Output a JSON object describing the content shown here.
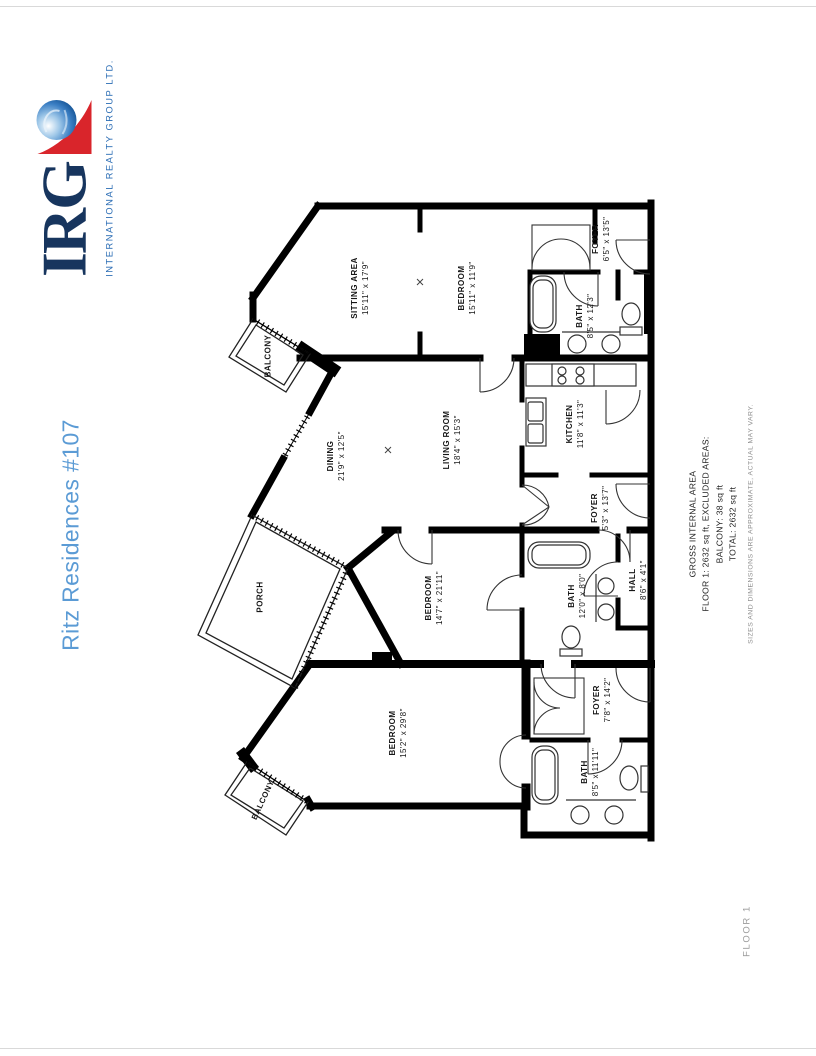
{
  "page": {
    "background": "#ffffff"
  },
  "logo": {
    "name": "IRG",
    "tagline": "INTERNATIONAL REALTY GROUP LTD.",
    "colors": {
      "navy": "#17355E",
      "red": "#D9252B",
      "tagline_blue": "#2A6CB4"
    }
  },
  "title": {
    "text": "Ritz Residences #107",
    "color": "#5B9BD5"
  },
  "plan": {
    "rooms": [
      {
        "name": "SITTING AREA",
        "dims": "15'11\" x 17'9\""
      },
      {
        "name": "BEDROOM",
        "dims": "15'11\" x 11'9\""
      },
      {
        "name": "FOYER",
        "dims": "6'5\" x 13'5\""
      },
      {
        "name": "BATH",
        "dims": "8'5\" x 12'3\""
      },
      {
        "name": "BALCONY",
        "dims": ""
      },
      {
        "name": "DINING",
        "dims": "21'9\" x 12'5\""
      },
      {
        "name": "LIVING ROOM",
        "dims": "18'4\" x 15'3\""
      },
      {
        "name": "KITCHEN",
        "dims": "11'8\" x 11'3\""
      },
      {
        "name": "FOYER",
        "dims": "5'3\" x 13'7\""
      },
      {
        "name": "PORCH",
        "dims": ""
      },
      {
        "name": "BEDROOM",
        "dims": "14'7\" x 21'11\""
      },
      {
        "name": "BATH",
        "dims": "12'0\" x 8'0\""
      },
      {
        "name": "HALL",
        "dims": "8'6\" x 4'1\""
      },
      {
        "name": "BEDROOM",
        "dims": "15'2\" x 29'8\""
      },
      {
        "name": "BALCONY",
        "dims": ""
      },
      {
        "name": "FOYER",
        "dims": "7'8\" x 14'2\""
      },
      {
        "name": "BATH",
        "dims": "8'5\" x 11'11\""
      }
    ]
  },
  "summary": {
    "heading": "GROSS INTERNAL AREA",
    "floor_line": "FLOOR 1: 2632 sq ft, EXCLUDED AREAS:",
    "balcony_line": "BALCONY: 38 sq ft",
    "total_line": "TOTAL: 2632 sq ft",
    "disclaimer": "SIZES AND DIMENSIONS ARE APPROXIMATE, ACTUAL MAY VARY."
  },
  "floor_label": "FLOOR 1"
}
